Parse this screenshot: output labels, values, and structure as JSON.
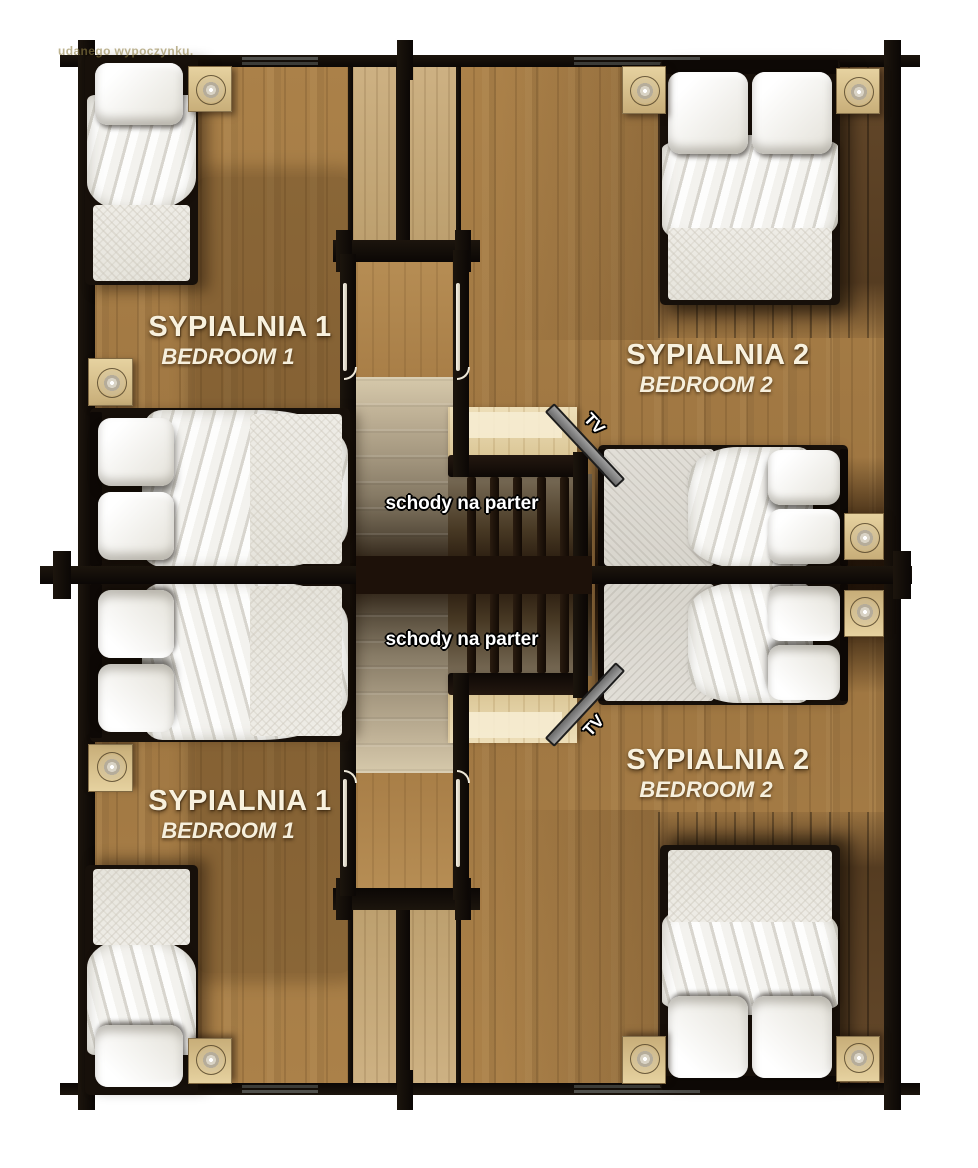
{
  "watermark": "udanego wypoczynku.",
  "rooms": {
    "top_left": {
      "pl": "SYPIALNIA 1",
      "en": "BEDROOM 1"
    },
    "top_right": {
      "pl": "SYPIALNIA 2",
      "en": "BEDROOM 2"
    },
    "bottom_left": {
      "pl": "SYPIALNIA 1",
      "en": "BEDROOM 1"
    },
    "bottom_right": {
      "pl": "SYPIALNIA 2",
      "en": "BEDROOM 2"
    }
  },
  "stairs": {
    "label": "schody na parter"
  },
  "tv": {
    "label": "TV"
  },
  "colors": {
    "wall": "#14100b",
    "floor": "#a67d47",
    "floor_dark": "#5e4326",
    "stair_light": "#d3c6a9",
    "landing": "#ecd9a8",
    "bedding": "#f2f1ed",
    "hall_tan": "#cdb183",
    "tv_stand": "#7d7d7d"
  }
}
